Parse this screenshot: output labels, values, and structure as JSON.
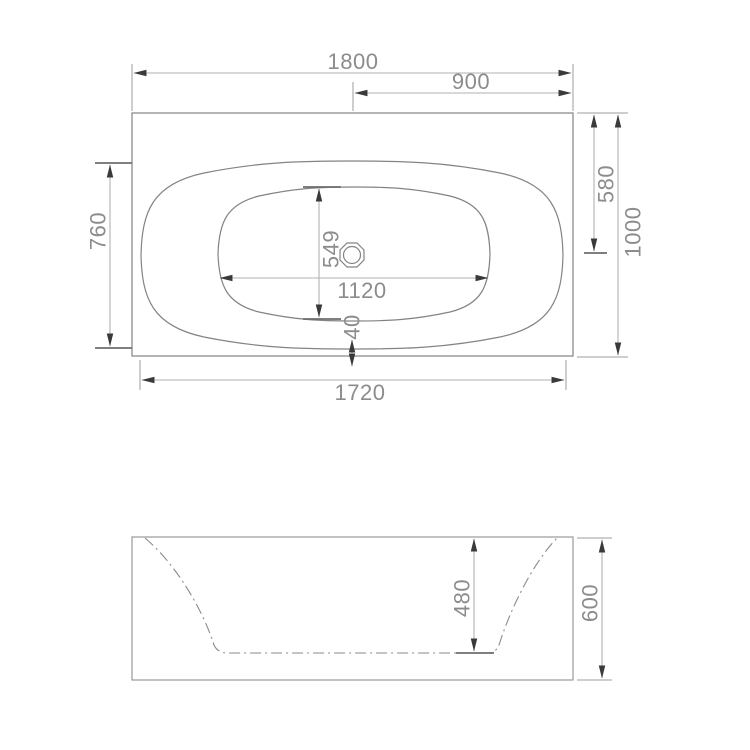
{
  "drawing": {
    "type": "bathtub-technical-drawing",
    "top_view": {
      "dims": {
        "overall_length": "1800",
        "center_to_end": "900",
        "edge_to_drain": "580",
        "overall_width": "1000",
        "shell_height": "760",
        "basin_length": "1120",
        "basin_width": "549",
        "rim_gap": "40",
        "shell_length": "1720"
      }
    },
    "side_view": {
      "dims": {
        "basin_depth": "480",
        "overall_height": "600"
      }
    }
  },
  "colors": {
    "background": "#ffffff",
    "geometry_line": "#838383",
    "dimension_line": "#b2b2b2",
    "extension_line": "#9c9c9c",
    "arrowhead": "#3a3a3a",
    "label_text": "#8c8c8c"
  }
}
